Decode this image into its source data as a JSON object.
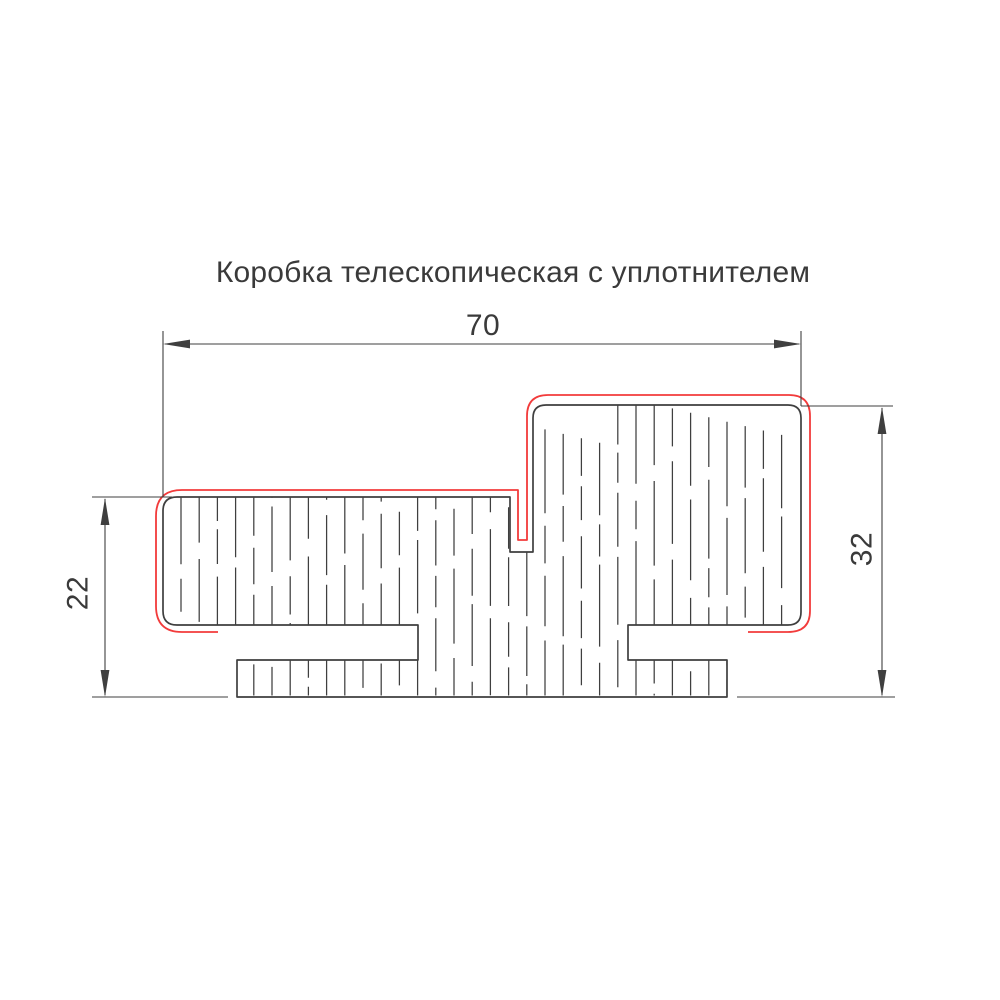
{
  "title": "Коробка телескопическая с уплотнителем",
  "dimensions": {
    "overall_width": "70",
    "left_thickness": "22",
    "right_thickness": "32"
  },
  "colors": {
    "outline": "#3f3f3f",
    "dimension_line": "#3f3f3f",
    "seal_line": "#f23b3b",
    "background": "#ffffff"
  }
}
